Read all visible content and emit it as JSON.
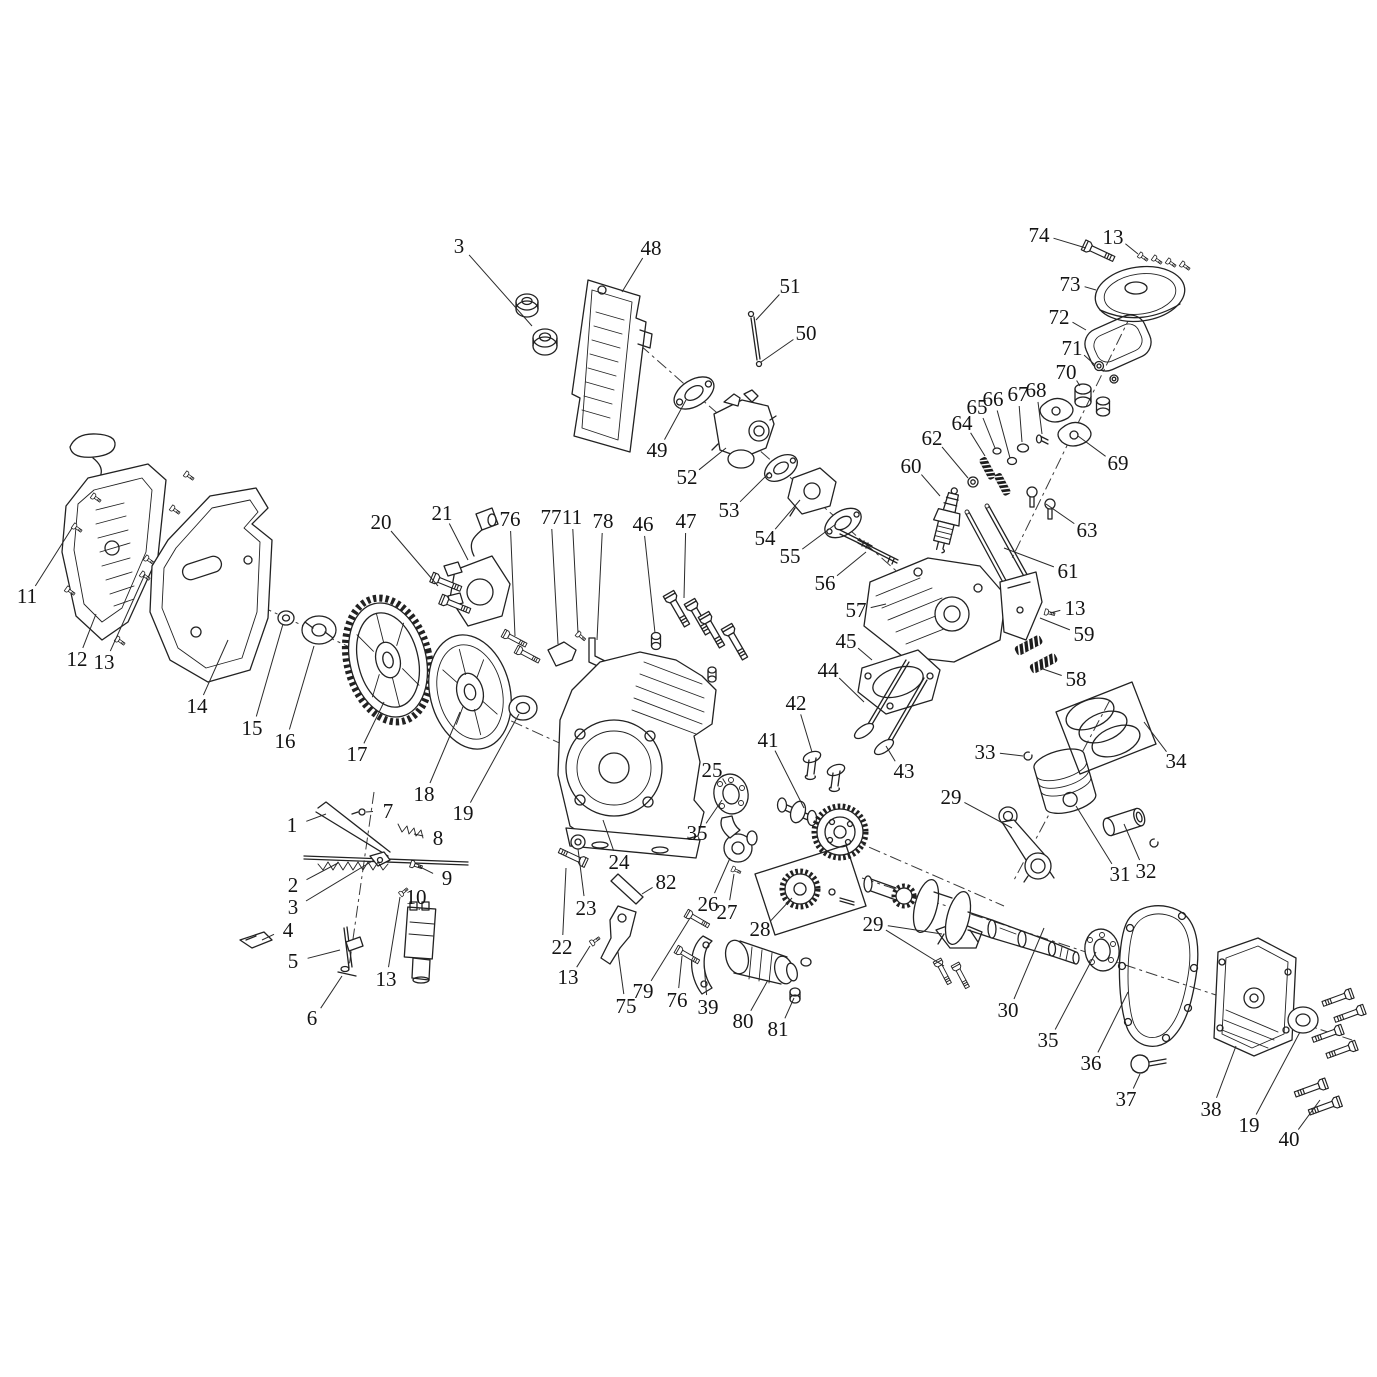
{
  "figure": {
    "type": "exploded-parts-diagram",
    "subject": "small gasoline engine exploded view",
    "background": "#ffffff",
    "line_color": "#222222",
    "leader_color": "#2a2a2a",
    "label_color": "#141414",
    "label_font_size": 21,
    "width": 1377,
    "height": 1377
  },
  "callouts": [
    {
      "n": "1",
      "x": 292,
      "y": 825,
      "to": [
        [
          326,
          814
        ]
      ]
    },
    {
      "n": "2",
      "x": 293,
      "y": 885,
      "to": [
        [
          338,
          863
        ]
      ]
    },
    {
      "n": "3",
      "x": 293,
      "y": 907,
      "to": [
        [
          374,
          860
        ]
      ]
    },
    {
      "n": "4",
      "x": 288,
      "y": 930,
      "to": [
        [
          262,
          940
        ]
      ]
    },
    {
      "n": "5",
      "x": 293,
      "y": 961,
      "to": [
        [
          340,
          950
        ]
      ]
    },
    {
      "n": "6",
      "x": 312,
      "y": 1018,
      "to": [
        [
          342,
          976
        ]
      ]
    },
    {
      "n": "7",
      "x": 388,
      "y": 811,
      "to": [
        [
          366,
          812
        ]
      ]
    },
    {
      "n": "8",
      "x": 438,
      "y": 838,
      "to": [
        [
          414,
          834
        ]
      ]
    },
    {
      "n": "9",
      "x": 447,
      "y": 878,
      "to": [
        [
          418,
          866
        ]
      ]
    },
    {
      "n": "10",
      "x": 416,
      "y": 897,
      "to": [
        [
          419,
          910
        ]
      ]
    },
    {
      "n": "11",
      "x": 27,
      "y": 596,
      "to": [
        [
          72,
          528
        ]
      ]
    },
    {
      "n": "11",
      "x": 572,
      "y": 517,
      "to": [
        [
          578,
          633
        ]
      ]
    },
    {
      "n": "12",
      "x": 77,
      "y": 659,
      "to": [
        [
          96,
          614
        ]
      ]
    },
    {
      "n": "13",
      "x": 104,
      "y": 662,
      "to": [
        [
          145,
          574
        ]
      ]
    },
    {
      "n": "13",
      "x": 386,
      "y": 979,
      "to": [
        [
          400,
          897
        ]
      ]
    },
    {
      "n": "13",
      "x": 568,
      "y": 977,
      "to": [
        [
          590,
          946
        ]
      ]
    },
    {
      "n": "13",
      "x": 1075,
      "y": 608,
      "to": [
        [
          1050,
          613
        ]
      ]
    },
    {
      "n": "13",
      "x": 1113,
      "y": 237,
      "to": [
        [
          1138,
          254
        ]
      ]
    },
    {
      "n": "14",
      "x": 197,
      "y": 706,
      "to": [
        [
          228,
          640
        ]
      ]
    },
    {
      "n": "15",
      "x": 252,
      "y": 728,
      "to": [
        [
          283,
          624
        ]
      ]
    },
    {
      "n": "16",
      "x": 285,
      "y": 741,
      "to": [
        [
          314,
          646
        ]
      ]
    },
    {
      "n": "17",
      "x": 357,
      "y": 754,
      "to": [
        [
          384,
          702
        ]
      ]
    },
    {
      "n": "18",
      "x": 424,
      "y": 794,
      "to": [
        [
          460,
          712
        ]
      ]
    },
    {
      "n": "19",
      "x": 463,
      "y": 813,
      "to": [
        [
          519,
          714
        ]
      ]
    },
    {
      "n": "19",
      "x": 1249,
      "y": 1125,
      "to": [
        [
          1300,
          1032
        ]
      ]
    },
    {
      "n": "20",
      "x": 381,
      "y": 522,
      "to": [
        [
          438,
          586
        ]
      ]
    },
    {
      "n": "21",
      "x": 442,
      "y": 513,
      "to": [
        [
          468,
          560
        ]
      ]
    },
    {
      "n": "22",
      "x": 562,
      "y": 947,
      "to": [
        [
          566,
          868
        ]
      ]
    },
    {
      "n": "23",
      "x": 586,
      "y": 908,
      "to": [
        [
          578,
          849
        ]
      ]
    },
    {
      "n": "24",
      "x": 619,
      "y": 862,
      "to": [
        [
          603,
          820
        ]
      ]
    },
    {
      "n": "25",
      "x": 712,
      "y": 770,
      "to": [
        [
          726,
          784
        ]
      ]
    },
    {
      "n": "26",
      "x": 708,
      "y": 904,
      "to": [
        [
          730,
          858
        ]
      ]
    },
    {
      "n": "27",
      "x": 727,
      "y": 912,
      "to": [
        [
          734,
          874
        ]
      ]
    },
    {
      "n": "28",
      "x": 760,
      "y": 929,
      "to": [
        [
          792,
          898
        ]
      ]
    },
    {
      "n": "29",
      "x": 951,
      "y": 797,
      "to": [
        [
          1012,
          828
        ]
      ]
    },
    {
      "n": "29",
      "x": 873,
      "y": 924,
      "to": [
        [
          942,
          934
        ],
        [
          944,
          966
        ]
      ]
    },
    {
      "n": "30",
      "x": 1008,
      "y": 1010,
      "to": [
        [
          1044,
          928
        ]
      ]
    },
    {
      "n": "31",
      "x": 1120,
      "y": 874,
      "to": [
        [
          1076,
          806
        ]
      ]
    },
    {
      "n": "32",
      "x": 1146,
      "y": 871,
      "to": [
        [
          1124,
          824
        ]
      ]
    },
    {
      "n": "33",
      "x": 985,
      "y": 752,
      "to": [
        [
          1023,
          756
        ]
      ]
    },
    {
      "n": "34",
      "x": 1176,
      "y": 761,
      "to": [
        [
          1144,
          722
        ]
      ]
    },
    {
      "n": "35",
      "x": 697,
      "y": 833,
      "to": [
        [
          722,
          800
        ]
      ]
    },
    {
      "n": "35",
      "x": 1048,
      "y": 1040,
      "to": [
        [
          1096,
          952
        ]
      ]
    },
    {
      "n": "36",
      "x": 1091,
      "y": 1063,
      "to": [
        [
          1128,
          992
        ]
      ]
    },
    {
      "n": "37",
      "x": 1126,
      "y": 1099,
      "to": [
        [
          1140,
          1074
        ]
      ]
    },
    {
      "n": "38",
      "x": 1211,
      "y": 1109,
      "to": [
        [
          1236,
          1046
        ]
      ]
    },
    {
      "n": "39",
      "x": 708,
      "y": 1007,
      "to": [
        [
          704,
          964
        ]
      ]
    },
    {
      "n": "40",
      "x": 1289,
      "y": 1139,
      "to": [
        [
          1320,
          1100
        ]
      ]
    },
    {
      "n": "41",
      "x": 768,
      "y": 740,
      "to": [
        [
          804,
          808
        ]
      ]
    },
    {
      "n": "42",
      "x": 796,
      "y": 703,
      "to": [
        [
          812,
          752
        ]
      ]
    },
    {
      "n": "43",
      "x": 904,
      "y": 771,
      "to": [
        [
          886,
          746
        ]
      ]
    },
    {
      "n": "44",
      "x": 828,
      "y": 670,
      "to": [
        [
          864,
          702
        ]
      ]
    },
    {
      "n": "45",
      "x": 846,
      "y": 641,
      "to": [
        [
          872,
          660
        ]
      ]
    },
    {
      "n": "46",
      "x": 643,
      "y": 524,
      "to": [
        [
          655,
          633
        ]
      ]
    },
    {
      "n": "47",
      "x": 686,
      "y": 521,
      "to": [
        [
          684,
          598
        ]
      ]
    },
    {
      "n": "48",
      "x": 651,
      "y": 248,
      "to": [
        [
          622,
          292
        ]
      ]
    },
    {
      "n": "49",
      "x": 657,
      "y": 450,
      "to": [
        [
          686,
          400
        ]
      ]
    },
    {
      "n": "50",
      "x": 806,
      "y": 333,
      "to": [
        [
          761,
          362
        ]
      ]
    },
    {
      "n": "51",
      "x": 790,
      "y": 286,
      "to": [
        [
          756,
          320
        ]
      ]
    },
    {
      "n": "52",
      "x": 687,
      "y": 477,
      "to": [
        [
          726,
          448
        ]
      ]
    },
    {
      "n": "53",
      "x": 729,
      "y": 510,
      "to": [
        [
          770,
          472
        ]
      ]
    },
    {
      "n": "54",
      "x": 765,
      "y": 538,
      "to": [
        [
          800,
          500
        ]
      ]
    },
    {
      "n": "55",
      "x": 790,
      "y": 556,
      "to": [
        [
          836,
          524
        ]
      ]
    },
    {
      "n": "56",
      "x": 825,
      "y": 583,
      "to": [
        [
          866,
          552
        ]
      ]
    },
    {
      "n": "57",
      "x": 856,
      "y": 610,
      "to": [
        [
          886,
          604
        ]
      ]
    },
    {
      "n": "58",
      "x": 1076,
      "y": 679,
      "to": [
        [
          1040,
          668
        ]
      ]
    },
    {
      "n": "59",
      "x": 1084,
      "y": 634,
      "to": [
        [
          1040,
          618
        ]
      ]
    },
    {
      "n": "60",
      "x": 911,
      "y": 466,
      "to": [
        [
          940,
          496
        ]
      ]
    },
    {
      "n": "61",
      "x": 1068,
      "y": 571,
      "to": [
        [
          1004,
          548
        ]
      ]
    },
    {
      "n": "62",
      "x": 932,
      "y": 438,
      "to": [
        [
          968,
          478
        ]
      ]
    },
    {
      "n": "63",
      "x": 1087,
      "y": 530,
      "to": [
        [
          1046,
          504
        ]
      ]
    },
    {
      "n": "64",
      "x": 962,
      "y": 423,
      "to": [
        [
          985,
          456
        ]
      ]
    },
    {
      "n": "65",
      "x": 977,
      "y": 407,
      "to": [
        [
          995,
          448
        ]
      ]
    },
    {
      "n": "66",
      "x": 993,
      "y": 399,
      "to": [
        [
          1010,
          458
        ]
      ]
    },
    {
      "n": "67",
      "x": 1018,
      "y": 394,
      "to": [
        [
          1022,
          442
        ]
      ]
    },
    {
      "n": "68",
      "x": 1036,
      "y": 390,
      "to": [
        [
          1042,
          434
        ]
      ]
    },
    {
      "n": "69",
      "x": 1118,
      "y": 463,
      "to": [
        [
          1078,
          436
        ]
      ]
    },
    {
      "n": "70",
      "x": 1066,
      "y": 372,
      "to": [
        [
          1080,
          386
        ]
      ]
    },
    {
      "n": "71",
      "x": 1072,
      "y": 348,
      "to": [
        [
          1094,
          364
        ]
      ]
    },
    {
      "n": "72",
      "x": 1059,
      "y": 317,
      "to": [
        [
          1086,
          330
        ]
      ]
    },
    {
      "n": "73",
      "x": 1070,
      "y": 284,
      "to": [
        [
          1096,
          290
        ]
      ]
    },
    {
      "n": "74",
      "x": 1039,
      "y": 235,
      "to": [
        [
          1086,
          248
        ]
      ]
    },
    {
      "n": "75",
      "x": 626,
      "y": 1006,
      "to": [
        [
          618,
          952
        ]
      ]
    },
    {
      "n": "76",
      "x": 510,
      "y": 519,
      "to": [
        [
          515,
          636
        ]
      ]
    },
    {
      "n": "76",
      "x": 677,
      "y": 1000,
      "to": [
        [
          682,
          956
        ]
      ]
    },
    {
      "n": "77",
      "x": 551,
      "y": 517,
      "to": [
        [
          558,
          644
        ]
      ]
    },
    {
      "n": "78",
      "x": 603,
      "y": 521,
      "to": [
        [
          597,
          640
        ]
      ]
    },
    {
      "n": "79",
      "x": 643,
      "y": 991,
      "to": [
        [
          690,
          918
        ]
      ]
    },
    {
      "n": "80",
      "x": 743,
      "y": 1021,
      "to": [
        [
          768,
          980
        ]
      ]
    },
    {
      "n": "81",
      "x": 778,
      "y": 1029,
      "to": [
        [
          794,
          998
        ]
      ]
    },
    {
      "n": "82",
      "x": 666,
      "y": 882,
      "to": [
        [
          642,
          894
        ]
      ]
    },
    {
      "n": "3",
      "x": 459,
      "y": 246,
      "to": [
        [
          532,
          326
        ]
      ]
    }
  ]
}
